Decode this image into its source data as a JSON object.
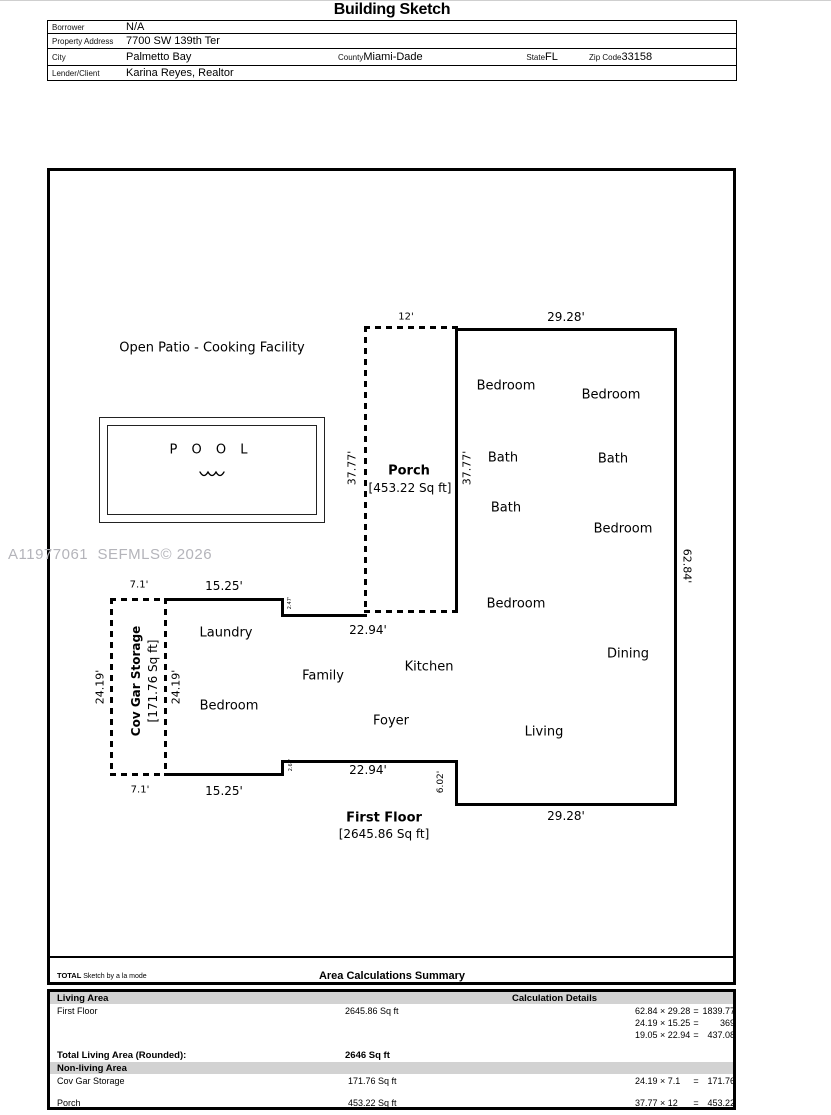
{
  "page": {
    "title": "Building Sketch"
  },
  "info": {
    "borrower_label": "Borrower",
    "borrower": "N/A",
    "address_label": "Property Address",
    "address": "7700 SW 139th Ter",
    "city_label": "City",
    "city": "Palmetto Bay",
    "county_label": "County",
    "county": "Miami-Dade",
    "state_label": "State",
    "state": "FL",
    "zip_label": "Zip Code",
    "zip": "33158",
    "lender_label": "Lender/Client",
    "lender": "Karina Reyes, Realtor"
  },
  "watermark": "A11977061  SEFMLS© 2026",
  "sketch": {
    "patio_label": "Open Patio - Cooking Facility",
    "pool_label": "P O O L",
    "porch_name": "Porch",
    "porch_area": "[453.22 Sq ft]",
    "garage_name": "Cov Gar Storage",
    "garage_area": "[171.76 Sq ft]",
    "first_floor_name": "First Floor",
    "first_floor_area": "[2645.86 Sq ft]",
    "rooms": [
      {
        "label": "Bedroom",
        "x": 506,
        "y": 386
      },
      {
        "label": "Bedroom",
        "x": 611,
        "y": 395
      },
      {
        "label": "Bath",
        "x": 503,
        "y": 458
      },
      {
        "label": "Bath",
        "x": 613,
        "y": 459
      },
      {
        "label": "Bath",
        "x": 506,
        "y": 508
      },
      {
        "label": "Bedroom",
        "x": 623,
        "y": 529
      },
      {
        "label": "Bedroom",
        "x": 516,
        "y": 604
      },
      {
        "label": "Dining",
        "x": 628,
        "y": 654
      },
      {
        "label": "Living",
        "x": 544,
        "y": 732
      },
      {
        "label": "Laundry",
        "x": 226,
        "y": 633
      },
      {
        "label": "Bedroom",
        "x": 229,
        "y": 706
      },
      {
        "label": "Family",
        "x": 323,
        "y": 676
      },
      {
        "label": "Kitchen",
        "x": 429,
        "y": 667
      },
      {
        "label": "Foyer",
        "x": 391,
        "y": 721
      }
    ],
    "dimensions": [
      {
        "label": "12'",
        "x": 406,
        "y": 317,
        "rot": 0,
        "size": 10
      },
      {
        "label": "29.28'",
        "x": 566,
        "y": 317,
        "rot": 0,
        "size": 12
      },
      {
        "label": "37.77'",
        "x": 352,
        "y": 468,
        "rot": -90,
        "size": 11
      },
      {
        "label": "37.77'",
        "x": 467,
        "y": 468,
        "rot": -90,
        "size": 11
      },
      {
        "label": "62.84'",
        "x": 687,
        "y": 566,
        "rot": 90,
        "size": 11
      },
      {
        "label": "22.94'",
        "x": 368,
        "y": 630,
        "rot": 0,
        "size": 12
      },
      {
        "label": "22.94'",
        "x": 368,
        "y": 770,
        "rot": 0,
        "size": 12
      },
      {
        "label": "6.02'",
        "x": 441,
        "y": 782,
        "rot": -90,
        "size": 9
      },
      {
        "label": "29.28'",
        "x": 566,
        "y": 816,
        "rot": 0,
        "size": 12
      },
      {
        "label": "15.25'",
        "x": 224,
        "y": 586,
        "rot": 0,
        "size": 12
      },
      {
        "label": "15.25'",
        "x": 224,
        "y": 791,
        "rot": 0,
        "size": 12
      },
      {
        "label": "7.1'",
        "x": 139,
        "y": 585,
        "rot": 0,
        "size": 10
      },
      {
        "label": "7.1'",
        "x": 140,
        "y": 790,
        "rot": 0,
        "size": 10
      },
      {
        "label": "24.19'",
        "x": 100,
        "y": 687,
        "rot": -90,
        "size": 11
      },
      {
        "label": "24.19'",
        "x": 176,
        "y": 687,
        "rot": -90,
        "size": 11
      },
      {
        "label": "2.47'",
        "x": 290,
        "y": 603,
        "rot": -90,
        "size": 5
      },
      {
        "label": "2.67'",
        "x": 291,
        "y": 765,
        "rot": -90,
        "size": 5
      }
    ]
  },
  "footer": {
    "brand_total": "TOTAL",
    "brand_rest": "Sketch by a la mode",
    "summary_title": "Area Calculations Summary"
  },
  "summary": {
    "living_header": "Living Area",
    "calc_header": "Calculation Details",
    "first_floor_name": "First Floor",
    "first_floor_area": "2645.86 Sq ft",
    "first_floor_calcs": [
      {
        "expr": "62.84 × 29.28",
        "result": "1839.77"
      },
      {
        "expr": "24.19 × 15.25",
        "result": "369"
      },
      {
        "expr": "19.05 × 22.94",
        "result": "437.08"
      }
    ],
    "total_label": "Total Living Area (Rounded):",
    "total_value": "2646 Sq ft",
    "nonliving_header": "Non-living Area",
    "nonliving": [
      {
        "name": "Cov Gar Storage",
        "area": "171.76 Sq ft",
        "expr": "24.19 × 7.1",
        "result": "171.76"
      },
      {
        "name": "Porch",
        "area": "453.22 Sq ft",
        "expr": "37.77 × 12",
        "result": "453.22"
      }
    ]
  }
}
